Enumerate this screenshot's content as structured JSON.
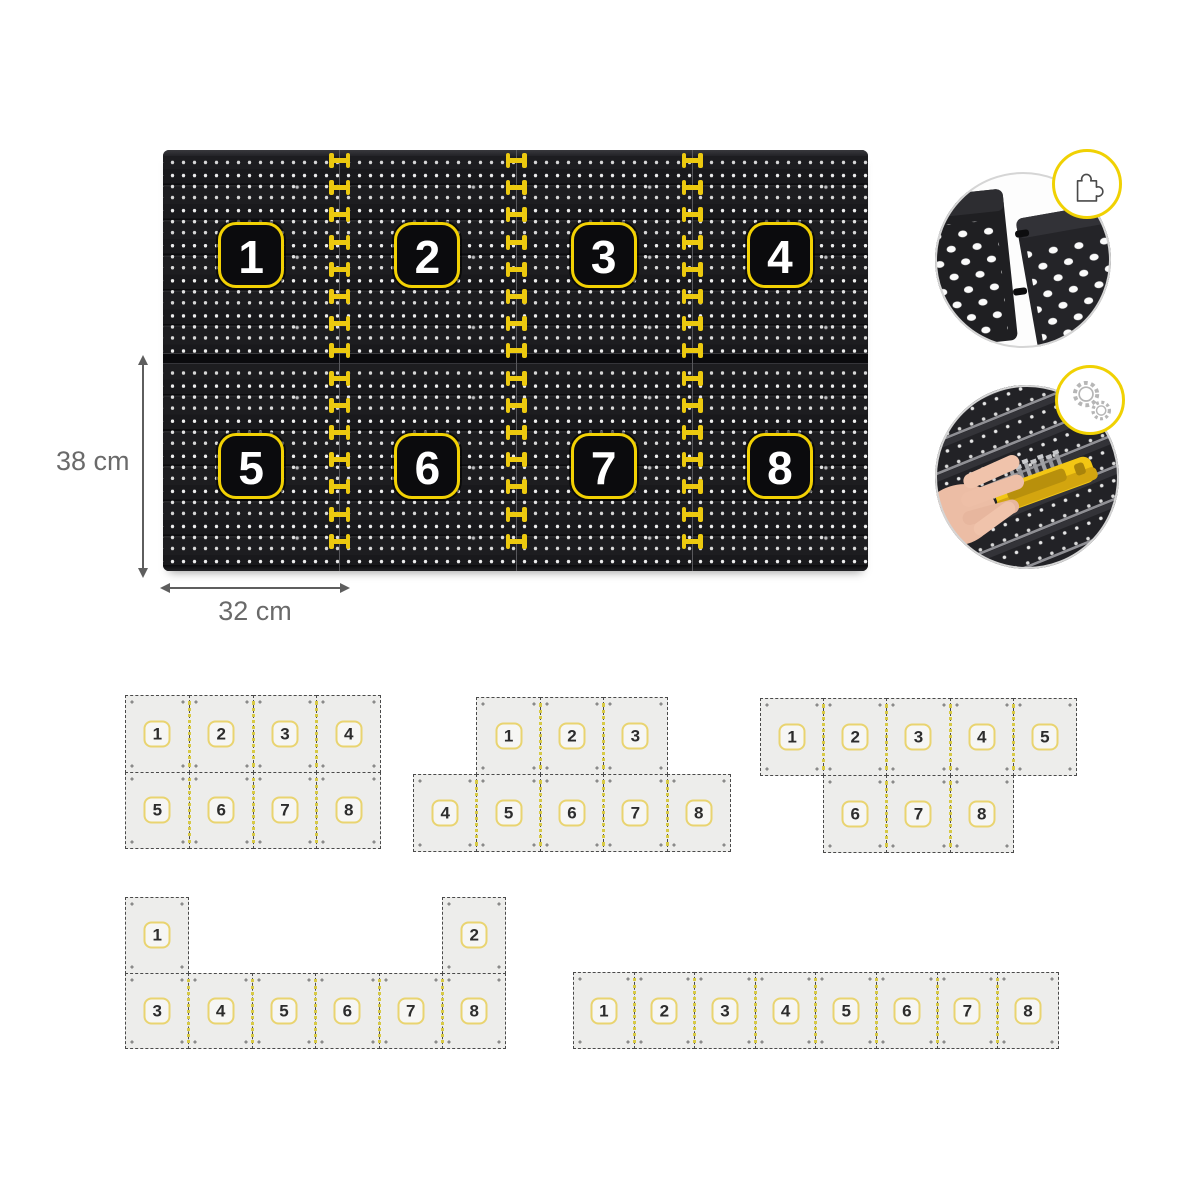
{
  "board": {
    "panel_numbers": [
      "1",
      "2",
      "3",
      "4",
      "5",
      "6",
      "7",
      "8"
    ],
    "height_label": "38 cm",
    "width_label": "32 cm"
  },
  "insets": {
    "connection": {
      "badge_icon": "puzzle-icon"
    },
    "mounting": {
      "badge_icon": "gears-icon"
    }
  },
  "layouts": [
    {
      "name": "layout-4x2-grid",
      "tiles": [
        {
          "n": "1",
          "c": 0,
          "r": 0
        },
        {
          "n": "2",
          "c": 1,
          "r": 0
        },
        {
          "n": "3",
          "c": 2,
          "r": 0
        },
        {
          "n": "4",
          "c": 3,
          "r": 0
        },
        {
          "n": "5",
          "c": 0,
          "r": 1
        },
        {
          "n": "6",
          "c": 1,
          "r": 1
        },
        {
          "n": "7",
          "c": 2,
          "r": 1
        },
        {
          "n": "8",
          "c": 3,
          "r": 1
        }
      ]
    },
    {
      "name": "layout-3-over-5",
      "tiles": [
        {
          "n": "1",
          "c": 1,
          "r": 0
        },
        {
          "n": "2",
          "c": 2,
          "r": 0
        },
        {
          "n": "3",
          "c": 3,
          "r": 0
        },
        {
          "n": "4",
          "c": 0,
          "r": 1
        },
        {
          "n": "5",
          "c": 1,
          "r": 1
        },
        {
          "n": "6",
          "c": 2,
          "r": 1
        },
        {
          "n": "7",
          "c": 3,
          "r": 1
        },
        {
          "n": "8",
          "c": 4,
          "r": 1
        }
      ]
    },
    {
      "name": "layout-5-over-3",
      "tiles": [
        {
          "n": "1",
          "c": 0,
          "r": 0
        },
        {
          "n": "2",
          "c": 1,
          "r": 0
        },
        {
          "n": "3",
          "c": 2,
          "r": 0
        },
        {
          "n": "4",
          "c": 3,
          "r": 0
        },
        {
          "n": "5",
          "c": 4,
          "r": 0
        },
        {
          "n": "6",
          "c": 1,
          "r": 1
        },
        {
          "n": "7",
          "c": 2,
          "r": 1
        },
        {
          "n": "8",
          "c": 3,
          "r": 1
        }
      ]
    },
    {
      "name": "layout-two-towers",
      "tiles": [
        {
          "n": "1",
          "c": 0,
          "r": 0
        },
        {
          "n": "2",
          "c": 5,
          "r": 0
        },
        {
          "n": "3",
          "c": 0,
          "r": 1
        },
        {
          "n": "4",
          "c": 1,
          "r": 1
        },
        {
          "n": "5",
          "c": 2,
          "r": 1
        },
        {
          "n": "6",
          "c": 3,
          "r": 1
        },
        {
          "n": "7",
          "c": 4,
          "r": 1
        },
        {
          "n": "8",
          "c": 5,
          "r": 1
        }
      ]
    },
    {
      "name": "layout-single-row",
      "tiles": [
        {
          "n": "1",
          "c": 0,
          "r": 0
        },
        {
          "n": "2",
          "c": 1,
          "r": 0
        },
        {
          "n": "3",
          "c": 2,
          "r": 0
        },
        {
          "n": "4",
          "c": 3,
          "r": 0
        },
        {
          "n": "5",
          "c": 4,
          "r": 0
        },
        {
          "n": "6",
          "c": 5,
          "r": 0
        },
        {
          "n": "7",
          "c": 6,
          "r": 0
        },
        {
          "n": "8",
          "c": 7,
          "r": 0
        }
      ]
    }
  ],
  "colors": {
    "accent_yellow": "#f0cb00",
    "board_black": "#17171a",
    "tile_gray": "#ededeb",
    "seam_yellow": "#d8ca45",
    "dimension_gray": "#6a6a6a"
  }
}
